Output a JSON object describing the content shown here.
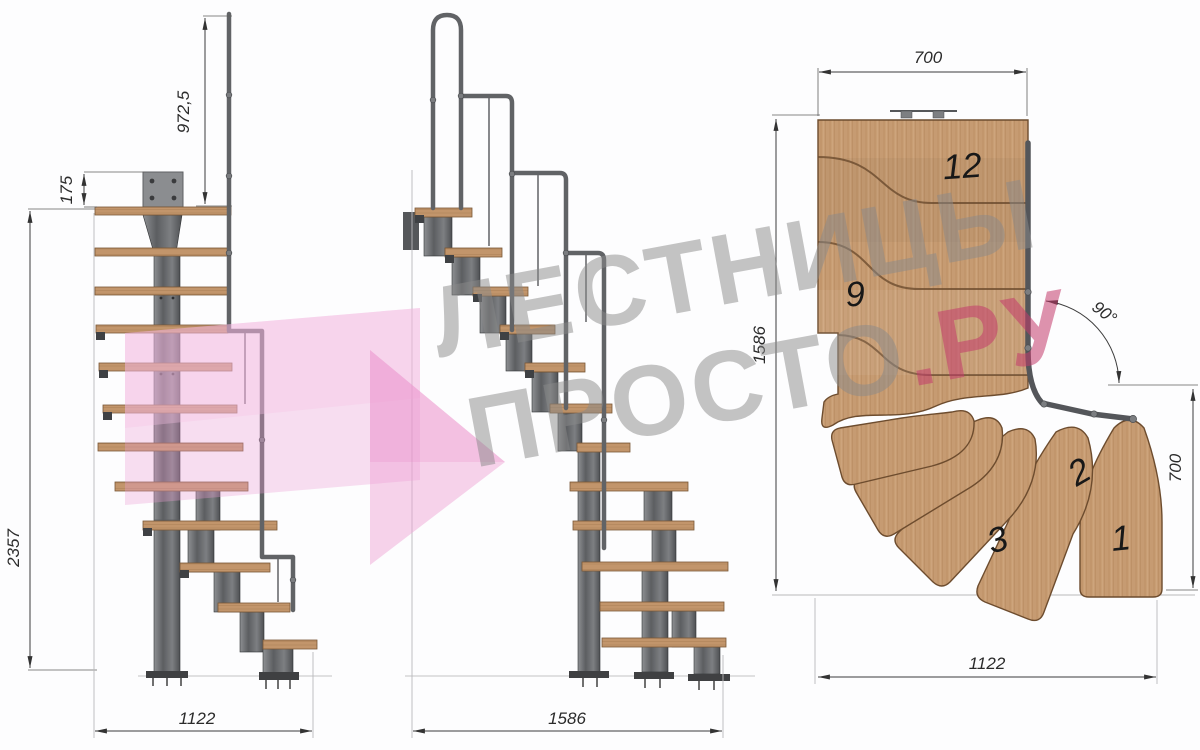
{
  "watermark": {
    "line1": "ЛЕСТНИЦЫ",
    "line2_main": "ПРОСТО",
    "line2_accent": ".РУ"
  },
  "left_view": {
    "dim_rail_height": "972,5",
    "dim_bracket_offset": "175",
    "dim_total_height": "2357",
    "dim_base_width": "1122"
  },
  "middle_view": {
    "dim_base_length": "1586"
  },
  "plan_view": {
    "dim_top_width": "700",
    "dim_left_depth": "1586",
    "dim_turn_angle": "90°",
    "dim_right_depth": "700",
    "dim_bottom_width": "1122",
    "steps": {
      "n1": "1",
      "n2": "2",
      "n3": "3",
      "n9": "9",
      "n12": "12"
    }
  },
  "colors": {
    "wood": "#c69b72",
    "metal": "#5c5e61",
    "dim_line": "#3c3c3c",
    "watermark_gray": "#8a8a8a",
    "watermark_pink": "#c43b6c",
    "arrow_pink": "#ee9ed3"
  }
}
